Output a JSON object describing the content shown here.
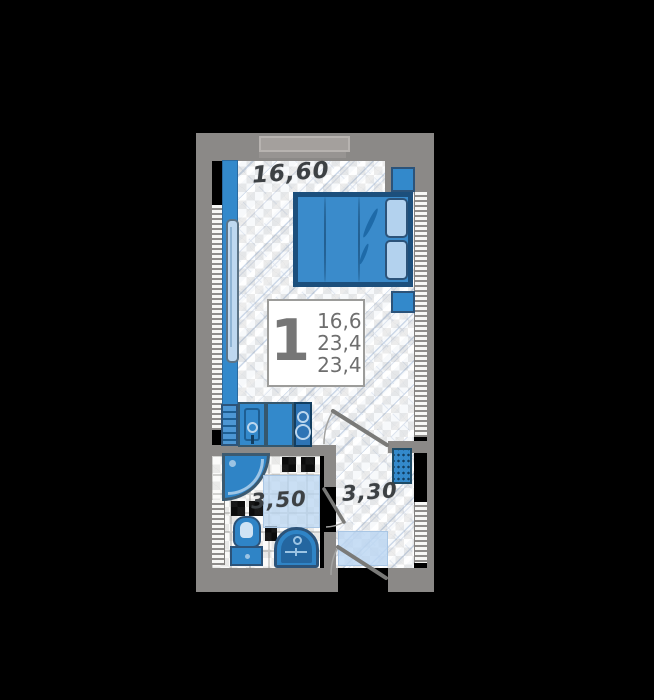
{
  "plan": {
    "labels": {
      "room_area": "16,60",
      "bathroom_area": "3,50",
      "hall_area": "3,30"
    },
    "summary": {
      "rooms": "1",
      "values": [
        "16,6",
        "23,4",
        "23,4"
      ]
    },
    "colors": {
      "background": "#000000",
      "wall_gray": "#8b8987",
      "furniture_blue": "#3389cb",
      "furniture_dark_blue": "#2e74b5",
      "outline_dark": "#35576d",
      "light_blue": "#b3d2ee",
      "mat_blue": "#bad6f2",
      "floor_white": "#f7f9fb",
      "hatch_line": "#ccd8e8",
      "label_text": "#3d4144",
      "info_text": "#6e6e6e"
    }
  }
}
